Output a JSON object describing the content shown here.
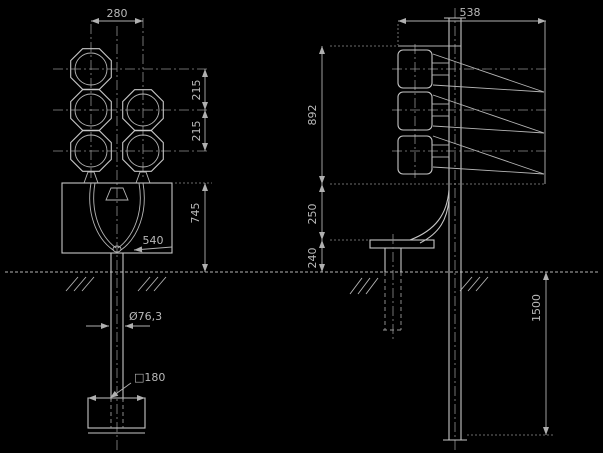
{
  "colors": {
    "background": "#000000",
    "line": "#c6c6c6",
    "dim_text": "#b9b9b9"
  },
  "front_view": {
    "dims": {
      "top_width": "280",
      "lamp_spacing_upper": "215",
      "lamp_spacing_lower": "215",
      "box_height": "745",
      "cable_loop": "540",
      "pole_diameter": "Ø76,3",
      "base_plate": "□180"
    }
  },
  "side_view": {
    "dims": {
      "top_width": "538",
      "signal_stack_height": "892",
      "bracket_drop": "250",
      "pedestal_height": "240",
      "foundation_depth": "1500"
    }
  }
}
